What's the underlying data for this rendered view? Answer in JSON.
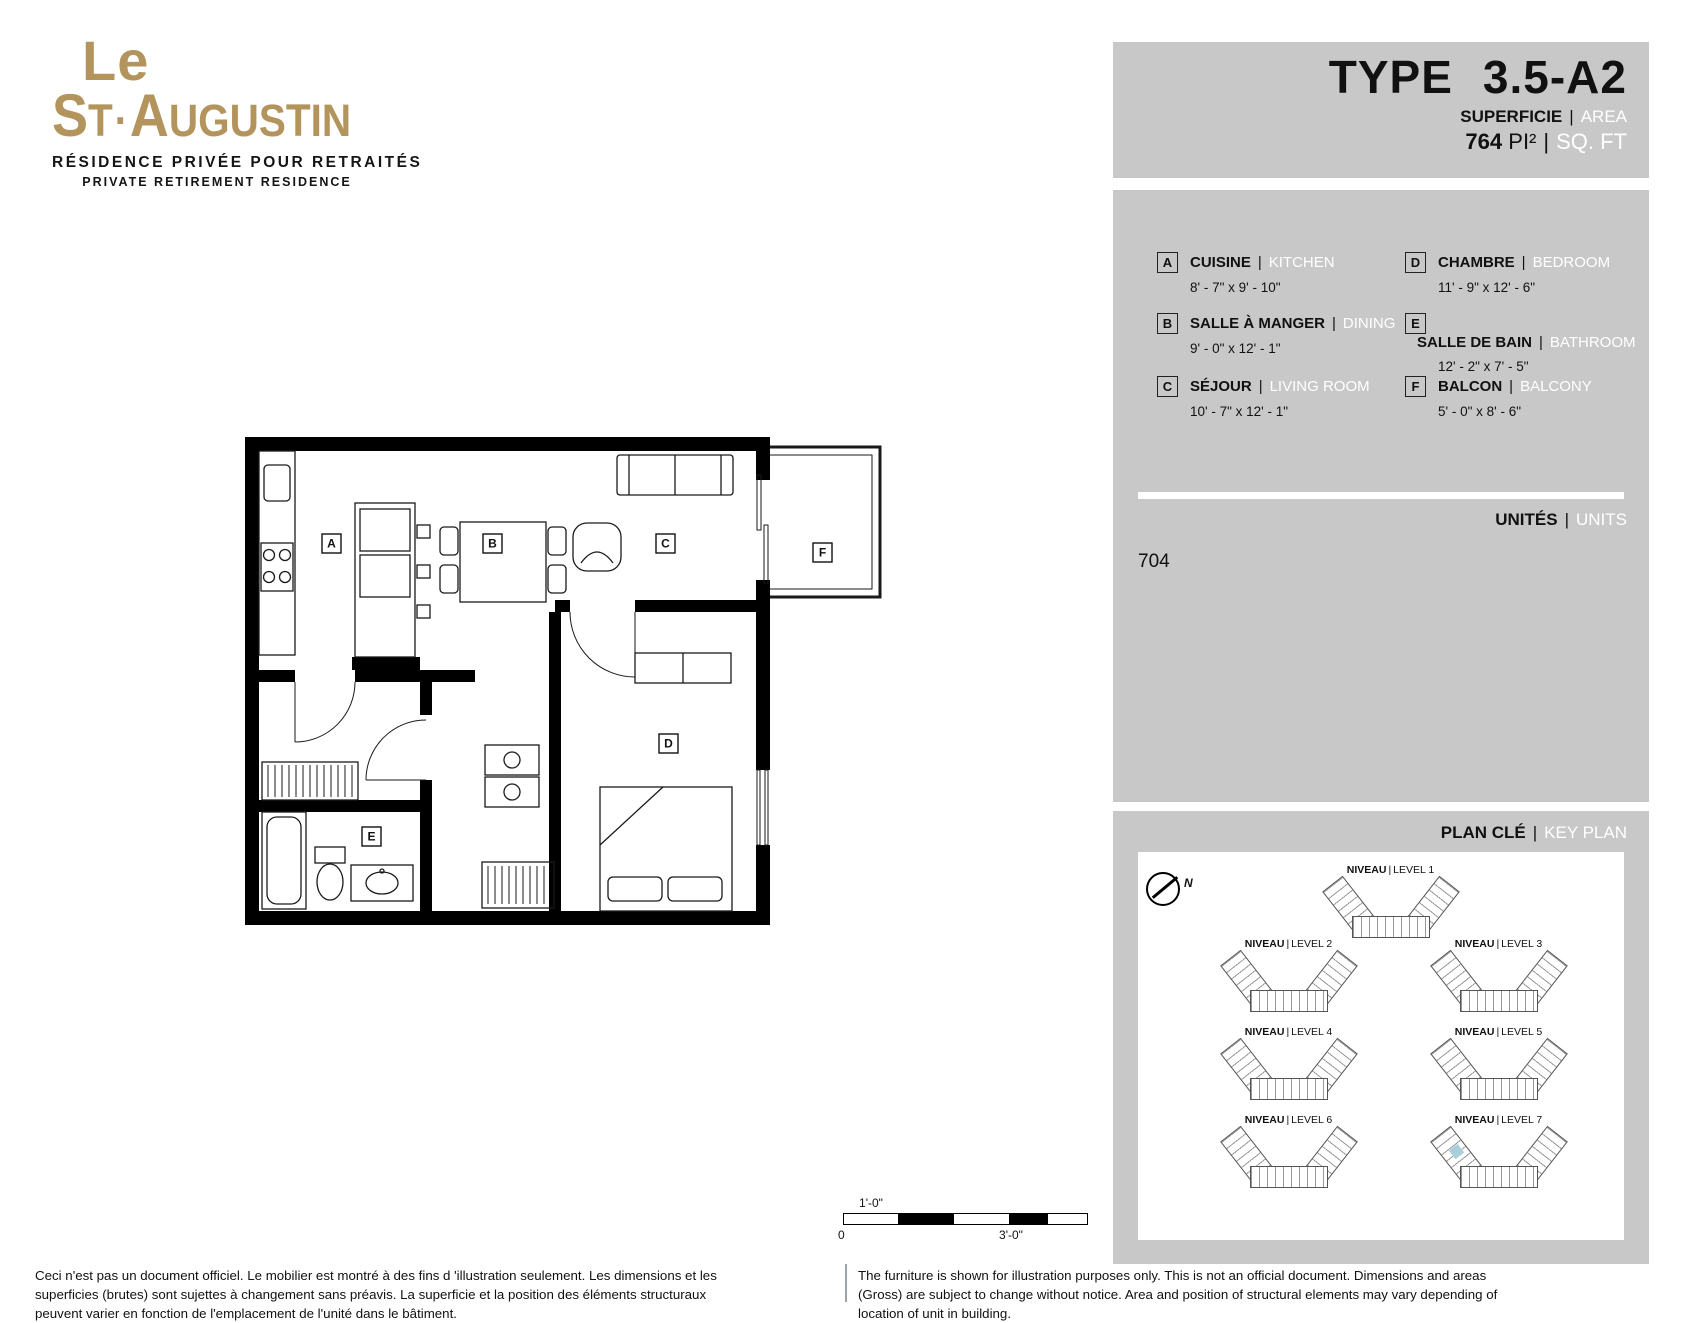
{
  "logo": {
    "line1": "Le",
    "main_s": "S",
    "main_t": "T",
    "main_dot": "·",
    "main_a": "A",
    "main_rest": "UGUSTIN",
    "tagline_fr": "RÉSIDENCE PRIVÉE POUR RETRAITÉS",
    "tagline_en": "PRIVATE RETIREMENT RESIDENCE"
  },
  "header": {
    "type_label": "TYPE",
    "type_value": "3.5-A2",
    "superficie": "SUPERFICIE",
    "area": "AREA",
    "pipe": "|",
    "size_value": "764",
    "size_unit_fr": "PI²",
    "size_unit_en": "SQ. FT"
  },
  "legend": {
    "items": [
      {
        "letter": "A",
        "fr": "CUISINE",
        "en": "KITCHEN",
        "dims": "8' - 7\" x 9' - 10\""
      },
      {
        "letter": "B",
        "fr": "SALLE À MANGER",
        "en": "DINING",
        "dims": "9' - 0\" x 12' - 1\""
      },
      {
        "letter": "C",
        "fr": "SÉJOUR",
        "en": "LIVING ROOM",
        "dims": "10' - 7\" x 12' - 1\""
      },
      {
        "letter": "D",
        "fr": "CHAMBRE",
        "en": "BEDROOM",
        "dims": "11' - 9\" x 12' - 6\""
      },
      {
        "letter": "E",
        "fr": "SALLE DE BAIN",
        "en": "BATHROOM",
        "dims": "12' - 2\" x 7' - 5\""
      },
      {
        "letter": "F",
        "fr": "BALCON",
        "en": "BALCONY",
        "dims": "5' - 0\" x 8' - 6\""
      }
    ]
  },
  "units": {
    "label_fr": "UNITÉS",
    "label_en": "UNITS",
    "pipe": "|",
    "value": "704"
  },
  "keyplan": {
    "title_fr": "PLAN CLÉ",
    "title_en": "KEY PLAN",
    "pipe": "|",
    "north": "N",
    "levels": [
      {
        "fr": "NIVEAU",
        "en": "LEVEL 1"
      },
      {
        "fr": "NIVEAU",
        "en": "LEVEL 2"
      },
      {
        "fr": "NIVEAU",
        "en": "LEVEL 3"
      },
      {
        "fr": "NIVEAU",
        "en": "LEVEL 4"
      },
      {
        "fr": "NIVEAU",
        "en": "LEVEL 5"
      },
      {
        "fr": "NIVEAU",
        "en": "LEVEL 6"
      },
      {
        "fr": "NIVEAU",
        "en": "LEVEL 7"
      }
    ]
  },
  "plan": {
    "labels": [
      "A",
      "B",
      "C",
      "D",
      "E",
      "F"
    ]
  },
  "scalebar": {
    "label_top": "1'-0\"",
    "label_zero": "0",
    "label_right": "3'-0\""
  },
  "disclaimer": {
    "fr": "Ceci n'est pas un document officiel.  Le mobilier est montré à des fins d 'illustration seulement.  Les dimensions et les superficies (brutes) sont sujettes à changement sans préavis. La superficie et la position des éléments structuraux peuvent varier en fonction de l'emplacement de l'unité dans le bâtiment.",
    "en": "The furniture is shown for illustration purposes only.  This is not an official document.  Dimensions and areas (Gross) are subject to change without notice. Area and position of structural elements may vary depending of location of unit in building."
  },
  "colors": {
    "brand_gold": "#b3945c",
    "panel_gray": "#c8c8c8",
    "highlight_blue": "#a9cfdb",
    "text_black": "#111111",
    "text_white": "#ffffff"
  }
}
